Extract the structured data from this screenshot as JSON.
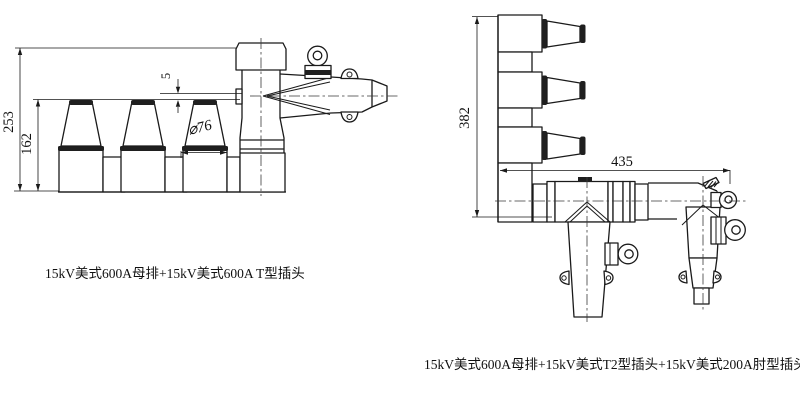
{
  "left": {
    "caption": "15kV美式600A母排+15kV美式600A T型插头",
    "dim_total_height": "253",
    "dim_bushing_height": "162",
    "dim_offset": "5",
    "dim_diameter": "⌀76"
  },
  "right": {
    "caption": "15kV美式600A母排+15kV美式T2型插头+15kV美式200A肘型插头",
    "dim_total_height": "382",
    "dim_total_width": "435"
  },
  "colors": {
    "line": "#1a1a1a",
    "background": "#ffffff"
  }
}
